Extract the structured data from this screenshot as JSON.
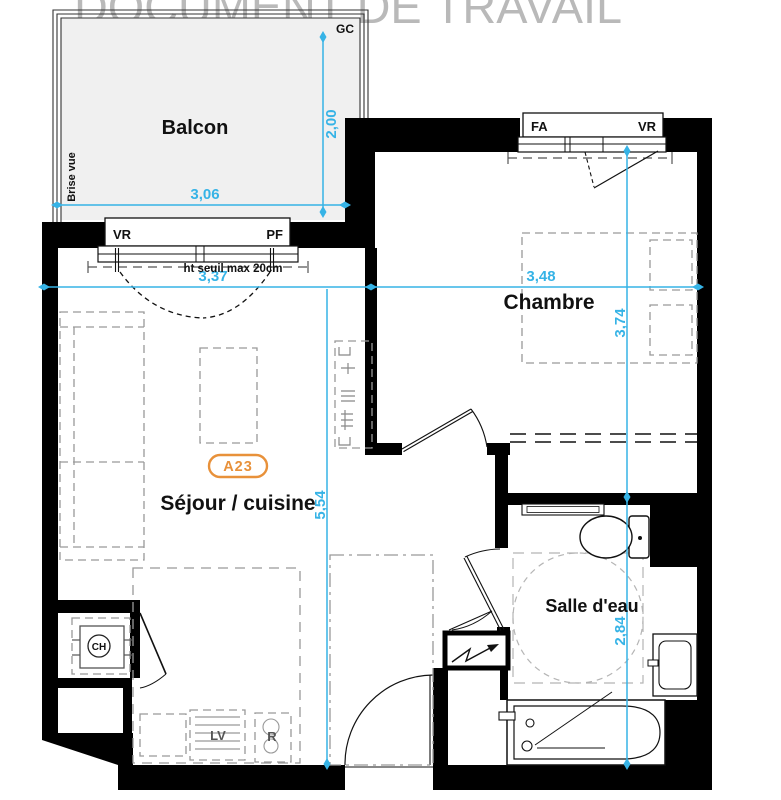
{
  "watermark": "DOCUMENT DE TRAVAIL",
  "badge": {
    "label": "A23"
  },
  "rooms": {
    "balcony": "Balcon",
    "bedroom": "Chambre",
    "living": "Séjour / cuisine",
    "bathroom": "Salle d'eau"
  },
  "annotations": {
    "brise_vue": "Brise vue",
    "gc": "GC",
    "threshold": "ht seuil max 20cm"
  },
  "windows": {
    "living": {
      "left": "VR",
      "right": "PF"
    },
    "bedroom": {
      "left": "FA",
      "right": "VR"
    }
  },
  "equipment": {
    "water_heater": "CH",
    "dishwasher": "LV",
    "fridge": "R"
  },
  "dimensions": {
    "balcony_width": "3,06",
    "balcony_depth": "2,00",
    "living_width": "3,37",
    "bedroom_width": "3,48",
    "bedroom_depth": "3,74",
    "living_depth": "5,54",
    "bathroom_depth": "2,84"
  },
  "colors": {
    "dimension_blue": "#36b3e6",
    "badge_orange": "#e8913a",
    "wall_black": "#000000",
    "furniture_gray": "#999999",
    "watermark_gray": "#b9b9b9",
    "balcony_fill": "#f0f0f0"
  }
}
